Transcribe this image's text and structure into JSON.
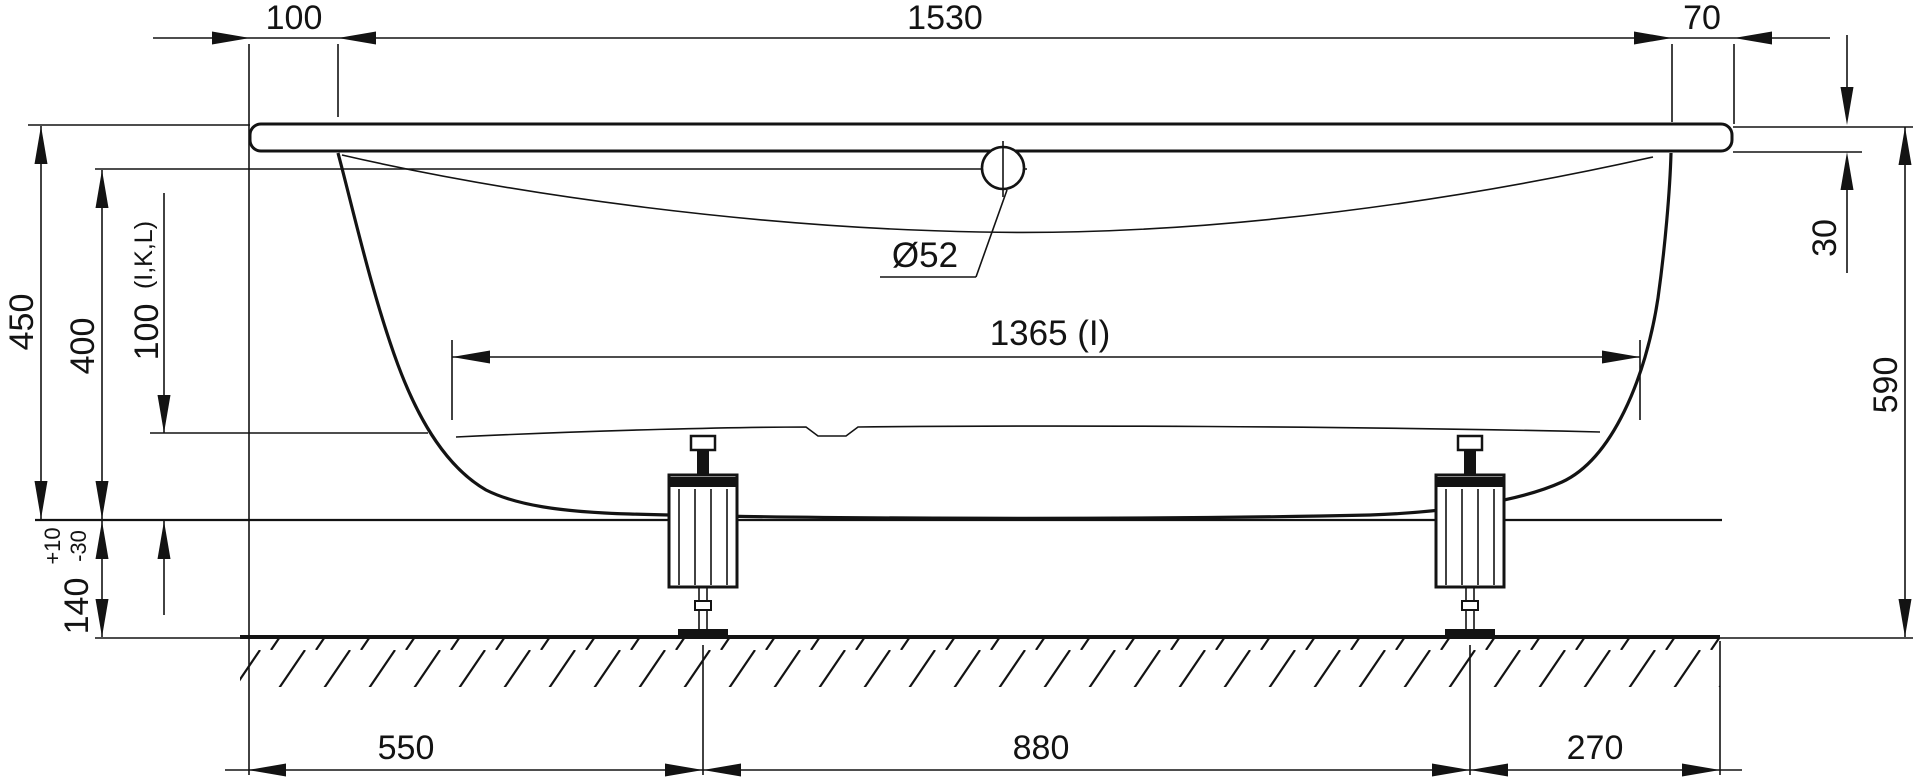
{
  "colors": {
    "ink": "#131313",
    "background": "#ffffff"
  },
  "drawing": {
    "type": "technical-dimension-drawing",
    "subject": "bathtub side cross-section with installation dimensions (mm)"
  },
  "labels": {
    "rim_overhang_left": "100",
    "shell_top_width": "1530",
    "rim_overhang_right": "70",
    "depth_total": "450",
    "depth_to_overflow": "400",
    "inner_depth_value": "100",
    "inner_depth_variants": "(I,K,L)",
    "foot_height": "140",
    "foot_height_tol_plus": "+10",
    "foot_height_tol_minus": "-30",
    "rim_profile_height": "30",
    "overall_height": "590",
    "bottom_length": "1365 (I)",
    "overflow_diameter": "Ø52",
    "foot_offset_left": "550",
    "foot_spacing": "880",
    "foot_offset_right": "270"
  }
}
